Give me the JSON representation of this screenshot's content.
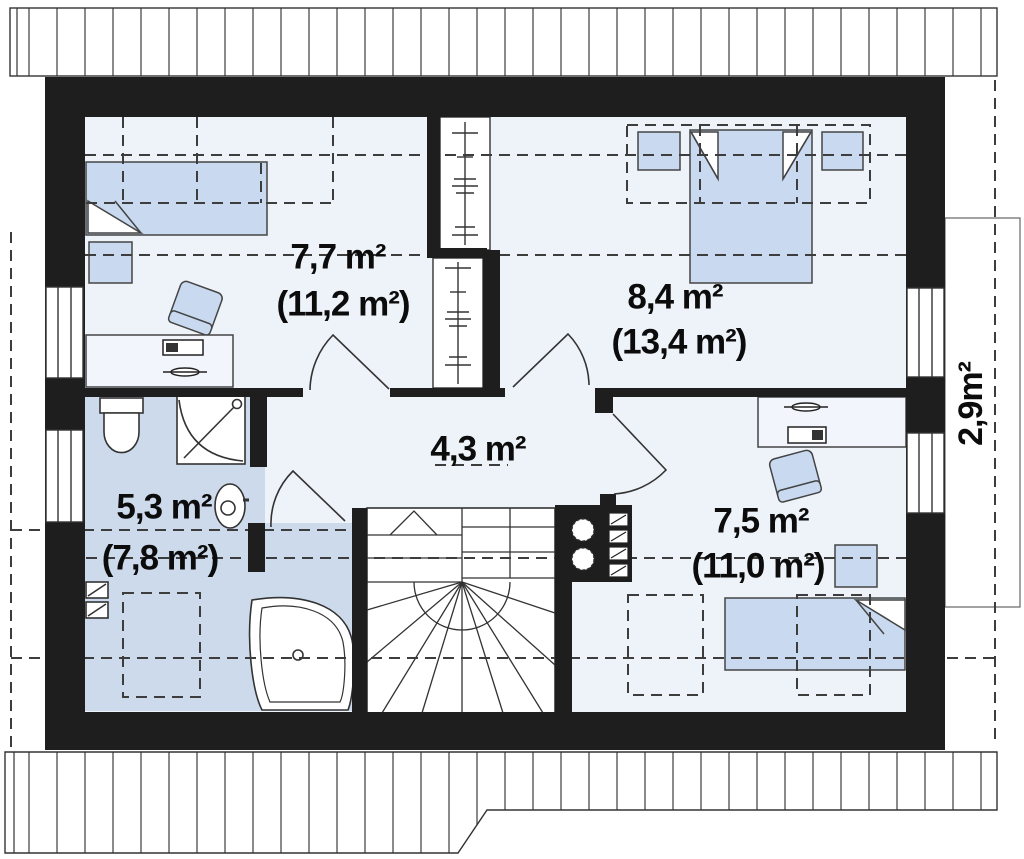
{
  "plan": {
    "type": "attic-floor-plan",
    "rooms": [
      {
        "id": "bedroom-top-left",
        "usable": "7,7 m²",
        "total": "(11,2 m²)"
      },
      {
        "id": "bedroom-top-right",
        "usable": "8,4 m²",
        "total": "(13,4 m²)"
      },
      {
        "id": "hall",
        "usable": "4,3 m²",
        "total": ""
      },
      {
        "id": "bathroom",
        "usable": "5,3 m²",
        "total": "(7,8 m²)"
      },
      {
        "id": "bedroom-bottom-right",
        "usable": "7,5 m²",
        "total": "(11,0 m²)"
      },
      {
        "id": "balcony",
        "usable": "2,9m²",
        "total": ""
      }
    ],
    "fixtures": [
      "single-bed",
      "double-bed",
      "bedside-table",
      "desk",
      "swivel-chair",
      "wardrobe-rail",
      "toilet",
      "corner-shower",
      "washbasin",
      "corner-bathtub",
      "winder-staircase",
      "chimney-flues",
      "ventilation-duct",
      "roof-overhang",
      "window",
      "door-swing"
    ],
    "colors": {
      "wall": "#1e1e1e",
      "floor": "#eef2f9",
      "bathroom_floor": "#ccdaec",
      "furniture": "#c9daf0",
      "line": "#333333",
      "dashed_line": "#3d3d3d"
    }
  }
}
